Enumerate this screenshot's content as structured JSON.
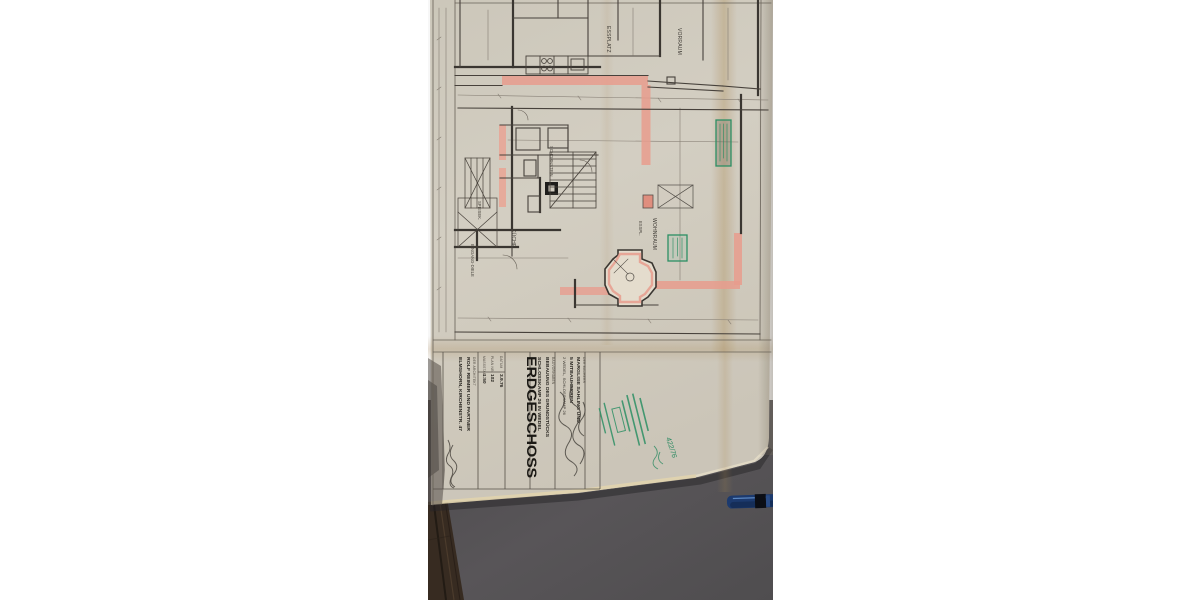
{
  "title_block": {
    "client_label": "DER BAUHERR",
    "client_line1": "MARGLISE SAHLING UND",
    "client_line2": "5 MITBAUHERREN",
    "client_line3": "2 WEDEL, SCHLOSSKAMP 26",
    "project_label": "BAUVORHABEN",
    "project_line1": "BEBAUUNG DES GRUNDSTÜCKS",
    "project_line2": "SCHLOSSKAMP 26 IN WEDEL",
    "sheet_title": "ERDGESCHOSS",
    "date_label": "DATUM",
    "date_value": "3.9.76",
    "plan_no_label": "PLAN NR.",
    "plan_no_value": "102",
    "scale_label": "MASSSTAB",
    "scale_value": "1:50",
    "architect_label": "DER ARCHITEKT",
    "architect_line1": "ROLF REIMER UND PARTNER",
    "architect_line2": "ELMSHORN, KIRCHENSTR. 47"
  },
  "stamp": {
    "file_number": "422/76"
  },
  "rooms": {
    "vorraum": "VORRAUM",
    "essplatz": "ESSPLATZ",
    "wohnraum": "WOHNRAUM",
    "esspl": "ESSPL.",
    "kueche": "KÜCHE",
    "speisek": "SPEISEK.",
    "eingang": "EINGANG-DIELE",
    "schornstein": "SCHORNSTEIN"
  },
  "colors": {
    "paper": "#d8d3c7",
    "desk": "#575456",
    "wall_highlight": "#f0a292",
    "stamp_green": "#2e8f66",
    "pen_blue": "#1d3c72"
  }
}
